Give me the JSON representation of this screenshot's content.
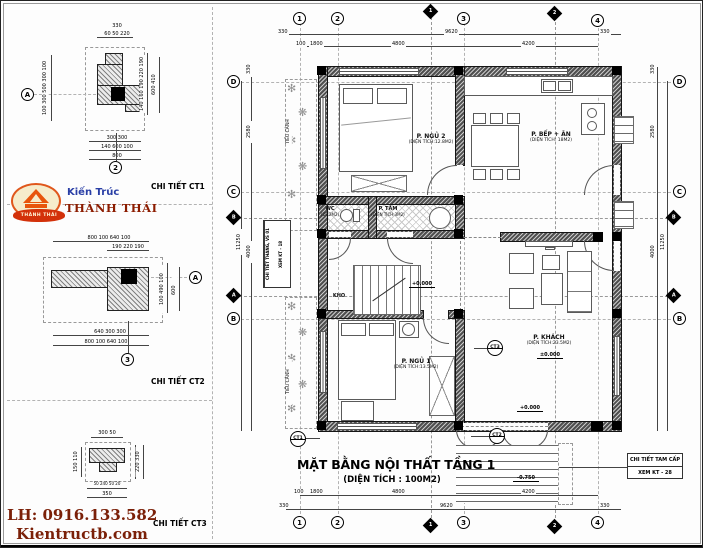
{
  "sheet": {
    "title_main": "MẶT BẰNG NỘI THẤT TẦNG 1",
    "title_sub": "(DIỆN TÍCH : 100M2)"
  },
  "branding": {
    "logo_top": "Kiến Trúc",
    "logo_name": "THÀNH THÁI",
    "logo_banner": "THÀNH THÁI",
    "phone": "LH: 0916.133.582",
    "website": "Kientructb.com"
  },
  "details": {
    "ct1": {
      "label": "CHI TIẾT CT1",
      "callout": "2",
      "axis": "A",
      "top": "330",
      "top2": "60 50 220",
      "left": "100 300 500 300 100",
      "right": "140 160 190 220 190",
      "right2": "600 410",
      "bottom": "300 300",
      "bottom2": "140 600 100",
      "bottom3": "800"
    },
    "ct2": {
      "label": "CHI TIẾT CT2",
      "callout": "3",
      "axis": "A",
      "top": "800 100 640 100",
      "top2": "190 220 190",
      "right": "100 490 100",
      "right2": "600",
      "bottom": "640 300 300",
      "bottom2": "800 100 640 100"
    },
    "ct3": {
      "label": "CHI TIẾT CT3",
      "top": "300 50",
      "left": "150 110",
      "right": "220 330",
      "bottom": "50 240 50 20",
      "bottom2": "350"
    }
  },
  "plan": {
    "rooms": {
      "bed2": {
        "name": "P. NGỦ 2",
        "area": "(DIỆN TÍCH:12.8M2)"
      },
      "kitchen": {
        "name": "P. BẾP + ĂN",
        "area": "(DIỆN TÍCH: 18M2)"
      },
      "wc": {
        "name": "WC",
        "area": "(DT:2M2)"
      },
      "bath": {
        "name": "P. TẮM",
        "area": "(DIỆN TÍCH:3M2)"
      },
      "living": {
        "name": "P. KHÁCH",
        "area": "(DIỆN TÍCH:23.5M2)"
      },
      "bed1": {
        "name": "P. NGỦ 1",
        "area": "(DIỆN TÍCH:13.5M2)"
      },
      "storage": {
        "name": "KHO"
      },
      "garden": {
        "name": "TIỂU CẢNH"
      }
    },
    "levels": {
      "zero": "±0.000",
      "plus": "+0.000",
      "minus": "-0.750"
    },
    "notes": {
      "stair1": "CHI TIẾT THANG, VS 01",
      "stair2": "XEM KT - 18",
      "steps1": "CHI TIẾT TAM CẤP",
      "steps2": "XEM KT - 28"
    },
    "callouts": {
      "c1": "CT1",
      "c2": "CT2",
      "c3": "CT3"
    },
    "grid": {
      "c1": "1",
      "c2": "2",
      "c3": "3",
      "c4": "4",
      "rD": "D",
      "rC": "C",
      "rB": "B",
      "s1": "1",
      "s2": "2",
      "sA": "A",
      "sB": "B"
    },
    "dims": {
      "d330": "330",
      "d9620": "9620",
      "d100": "100",
      "d1800": "1800",
      "d4800": "4800",
      "d4200": "4200",
      "d2580": "2580",
      "d4000": "4000",
      "d11250": "11250"
    }
  }
}
